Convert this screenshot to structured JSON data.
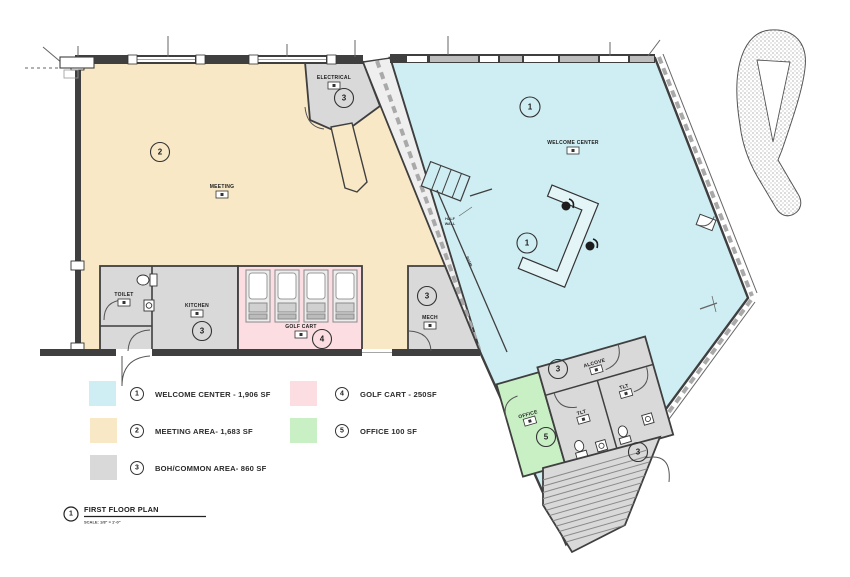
{
  "colors": {
    "welcome_center": "#cfeef3",
    "meeting_area": "#f9e8c6",
    "boh_common": "#d9d9d9",
    "golf_cart": "#fbdde2",
    "office": "#c9f0c5",
    "wall": "#3f3f3f"
  },
  "legend": {
    "items": [
      {
        "number": "1",
        "label": "WELCOME CENTER - 1,906 SF",
        "color": "#cfeef3"
      },
      {
        "number": "2",
        "label": "MEETING AREA- 1,683 SF",
        "color": "#f9e8c6"
      },
      {
        "number": "3",
        "label": "BOH/COMMON AREA- 860 SF",
        "color": "#d9d9d9"
      },
      {
        "number": "4",
        "label": "GOLF CART - 250SF",
        "color": "#fbdde2"
      },
      {
        "number": "5",
        "label": "OFFICE 100 SF",
        "color": "#c9f0c5"
      }
    ]
  },
  "title_block": {
    "number": "1",
    "title": "FIRST FLOOR PLAN",
    "scale": "SCALE:  1/8\" = 1'-0\""
  },
  "rooms": {
    "welcome_center": {
      "label": "WELCOME CENTER",
      "number": "1"
    },
    "meeting": {
      "label": "MEETING",
      "number": "2"
    },
    "electrical": {
      "label": "ELECTRICAL",
      "number": "3"
    },
    "toilet": {
      "label": "TOILET"
    },
    "kitchen": {
      "label": "KITCHEN",
      "number": "3"
    },
    "golf_cart": {
      "label": "GOLF CART",
      "number": "4"
    },
    "mech": {
      "label": "MECH",
      "number": "3"
    },
    "alcove": {
      "label": "ALCOVE",
      "number": "3"
    },
    "tlt": {
      "label": "TLT"
    },
    "office": {
      "label": "OFFICE",
      "number": "5"
    },
    "stairs": {
      "number": "3"
    }
  },
  "notes": {
    "half_wall_line1": "HALF",
    "half_wall_line2": "WALL",
    "ramp": "RAMP"
  }
}
